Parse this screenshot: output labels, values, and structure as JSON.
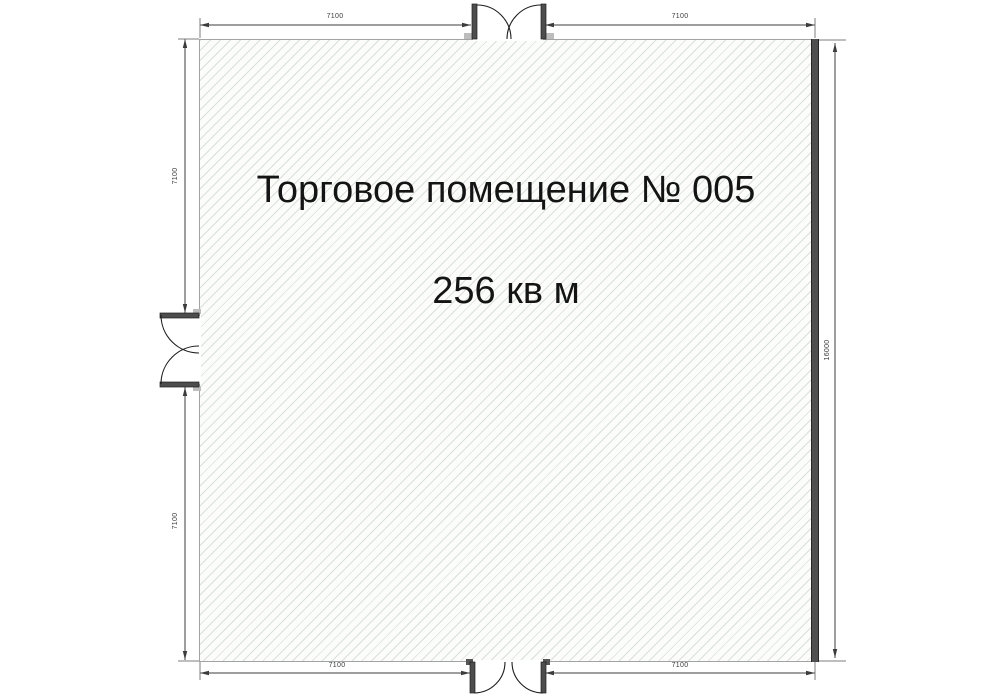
{
  "plan": {
    "title": "Торговое помещение № 005",
    "area": "256 кв м"
  },
  "dimensions": {
    "top_left": "7100",
    "top_right": "7100",
    "left_upper": "7100",
    "left_lower": "7100",
    "bottom_left": "7100",
    "bottom_right": "7100",
    "right_full": "16000"
  },
  "doors": {
    "top": "double-door",
    "left": "double-door",
    "bottom": "double-door"
  },
  "colors": {
    "floor_bg": "#fcfcfa",
    "hatch_line": "#d9e1d9",
    "outline": "#a3a3a3",
    "wall_dark": "#4f4f4f",
    "dim_line": "#3c3c3c",
    "text": "#141414"
  }
}
